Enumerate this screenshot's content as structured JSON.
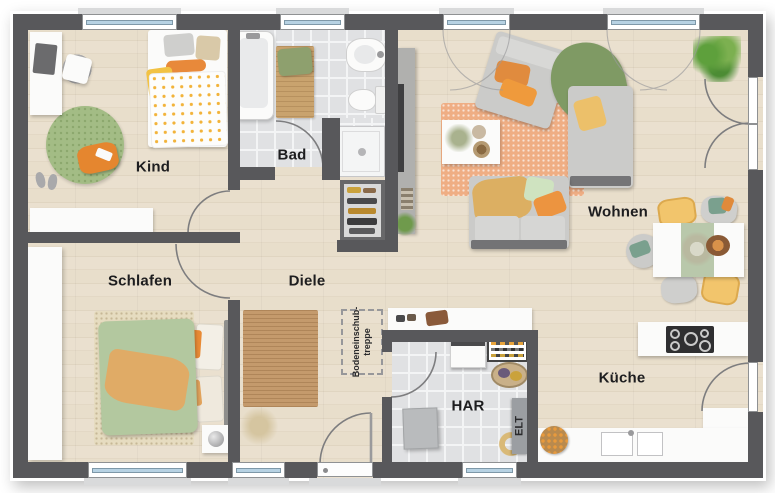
{
  "plan": {
    "type": "residential floor plan (top view)",
    "rooms": {
      "kind": {
        "label": "Kind"
      },
      "bad": {
        "label": "Bad"
      },
      "wohnen": {
        "label": "Wohnen"
      },
      "schlafen": {
        "label": "Schlafen"
      },
      "diele": {
        "label": "Diele"
      },
      "har": {
        "label": "HAR"
      },
      "kueche": {
        "label": "Küche"
      }
    },
    "annotations": {
      "attic_stairs_line1": "Bodeneinschub-",
      "attic_stairs_line2": "treppe",
      "elt": "ELT"
    },
    "colors": {
      "wall": "#58585b",
      "wood_floor": "#e8decd",
      "tile_floor": "#e0e1e3",
      "window_glass": "#b7d2e3",
      "furniture_white": "#fbfbfa",
      "sofa_gray": "#cbcbc9",
      "accent_orange": "#e5862f",
      "accent_yellow": "#f2c56c",
      "accent_green_rug": "#a3bc85",
      "duvet_green": "#b3c89f",
      "rug_coral": "#efae84",
      "runner_wood": "#c49a6c",
      "label_text": "#1d1d1f"
    }
  }
}
